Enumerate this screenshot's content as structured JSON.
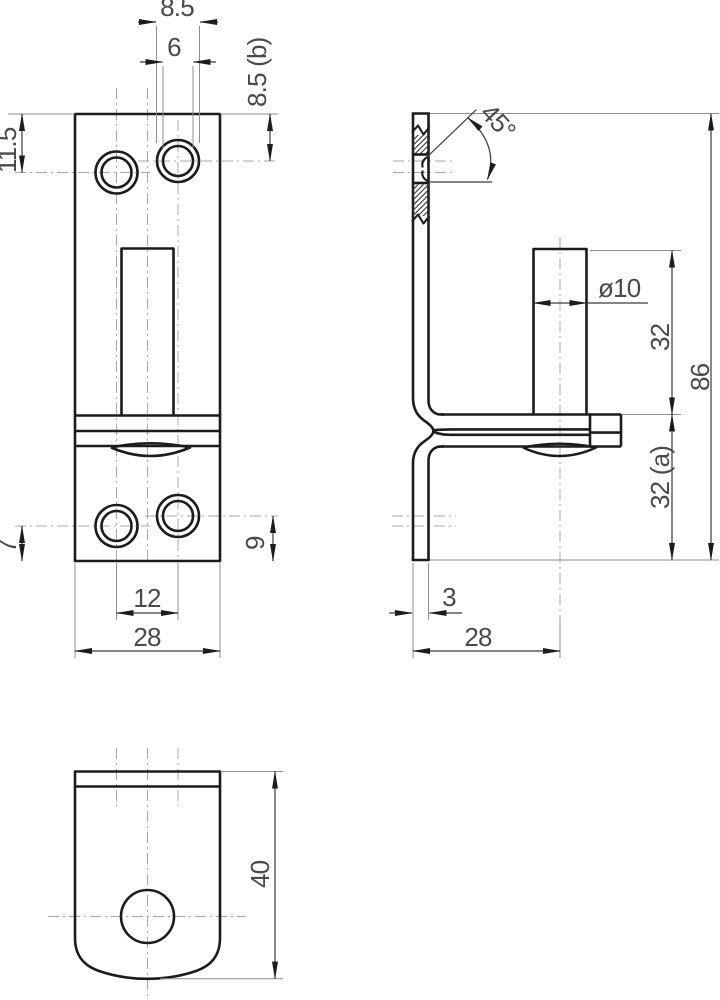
{
  "drawing": {
    "type": "orthographic technical drawing, bracket with riveted pin",
    "colors": {
      "background": "#ffffff",
      "outline": "#1c1c1c",
      "dimension_line": "#3a3a3a",
      "extension_line": "#8f8f8f",
      "centerline": "#a9a9a9",
      "dim_text": "#4a4a4a"
    },
    "front_view": {
      "dims": {
        "eyelet_outer_dia": "8.5",
        "eyelet_inner_dia": "6",
        "top_to_right_hole": "8.5 (b)",
        "top_to_left_hole": "11.5",
        "bottom_to_left_hole": "7",
        "bottom_to_right_hole": "9",
        "hole_spacing": "12",
        "plate_width": "28"
      }
    },
    "side_view": {
      "dims": {
        "bevel_angle": "45°",
        "pin_diameter": "ø10",
        "pin_length": "32",
        "overall_height": "86",
        "lower_section": "32 (a)",
        "material_thickness": "3",
        "leg_depth": "28"
      }
    },
    "bottom_view": {
      "dims": {
        "leg_length": "40"
      }
    }
  }
}
